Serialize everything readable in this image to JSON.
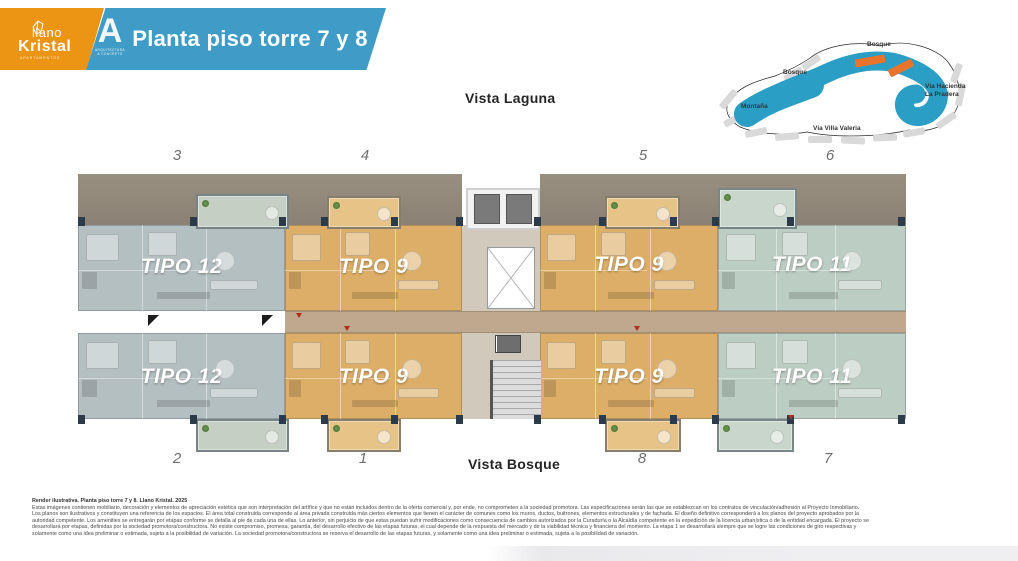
{
  "header": {
    "brand": {
      "line1": "llano",
      "line2": "Kristal",
      "tagline": "APARTAMENTOS"
    },
    "partner": {
      "letter": "A",
      "caption1": "ARQUITECTURA",
      "caption2": "& CONCRETO"
    },
    "title": "Planta piso torre 7 y 8",
    "colors": {
      "orange": "#EC9414",
      "blue": "#3F9CC6"
    }
  },
  "plan": {
    "view_top": "Vista Laguna",
    "view_bottom": "Vista Bosque",
    "numbers_top": [
      "3",
      "4",
      "5",
      "6"
    ],
    "numbers_bottom": [
      "2",
      "1",
      "8",
      "7"
    ],
    "units": [
      {
        "label": "TIPO 12",
        "position": "top-left",
        "color": "#b4bfc2"
      },
      {
        "label": "TIPO 9",
        "position": "top-center-left",
        "color": "#dcae67"
      },
      {
        "label": "TIPO 9",
        "position": "top-center-right",
        "color": "#dcae67"
      },
      {
        "label": "TIPO 11",
        "position": "top-right",
        "color": "#bccdc3"
      },
      {
        "label": "TIPO 12",
        "position": "bottom-left",
        "color": "#b4bfc2"
      },
      {
        "label": "TIPO 9",
        "position": "bottom-center-left",
        "color": "#dcae67"
      },
      {
        "label": "TIPO 9",
        "position": "bottom-center-right",
        "color": "#dcae67"
      },
      {
        "label": "TIPO 11",
        "position": "bottom-right",
        "color": "#bccdc3"
      }
    ]
  },
  "map": {
    "labels": {
      "bosque_top": "Bosque",
      "bosque_left": "Bosque",
      "montana": "Montaña",
      "via_villa": "Vía Villa Valeria",
      "via_hacienda_1": "Vía Hacienda",
      "via_hacienda_2": "La Pradera"
    },
    "water_color": "#2B9EC6",
    "highlight_color": "#E8742B",
    "block_color": "#D9D9D9"
  },
  "disclaimer": {
    "title": "Render ilustrativa. Planta piso torre 7 y 8. Llano Kristal. 2025",
    "lines": [
      "Estas imágenes contienen mobiliario, decoración y elementos de apreciación estética que son interpretación del artífice y que no están incluidos dentro de la oferta comercial y, por ende, no comprometen a la sociedad promotora. Las especificaciones serán las que se establezcan en los contratos de vinculación/adhesión al Proyecto Inmobiliario.",
      "Los planos son ilustrativos y constituyen una referencia de los espacios. El área total construida corresponde al área privada construida más ciertos elementos que tienen el carácter de comunes como los muros, ductos, buitrones, elementos estructurales y de fachada. El diseño definitivo corresponderá a los planos del proyecto aprobados por la",
      "autoridad competente. Los amenities se entregarán por etapas conforme se detalla al pie de cada una de ellas. Lo anterior, sin perjuicio de que estas puedan sufrir modificaciones como consecuencia de cambios autorizados por la Curaduría o la Alcaldía competente en la expedición de la licencia urbanística o de la entidad encargada. El proyecto se",
      "desarrollará por etapas, definidas por la sociedad promotora/constructora. No existe compromiso, promesa, garantía, del desarrollo efectivo de las etapas futuras, el cual depende de la respuesta del mercado y de la viabilidad técnica y financiera del momento. La etapa 1 se desarrollará siempre que se logre las condiciones de giro respectivas y",
      "solamente como una idea preliminar o estimada, sujeta a la posibilidad de variación. La sociedad promotora/constructora se reserva el desarrollo de las etapas futuras, y solamente como una idea preliminar o estimada, sujeta a la posibilidad de variación."
    ]
  }
}
